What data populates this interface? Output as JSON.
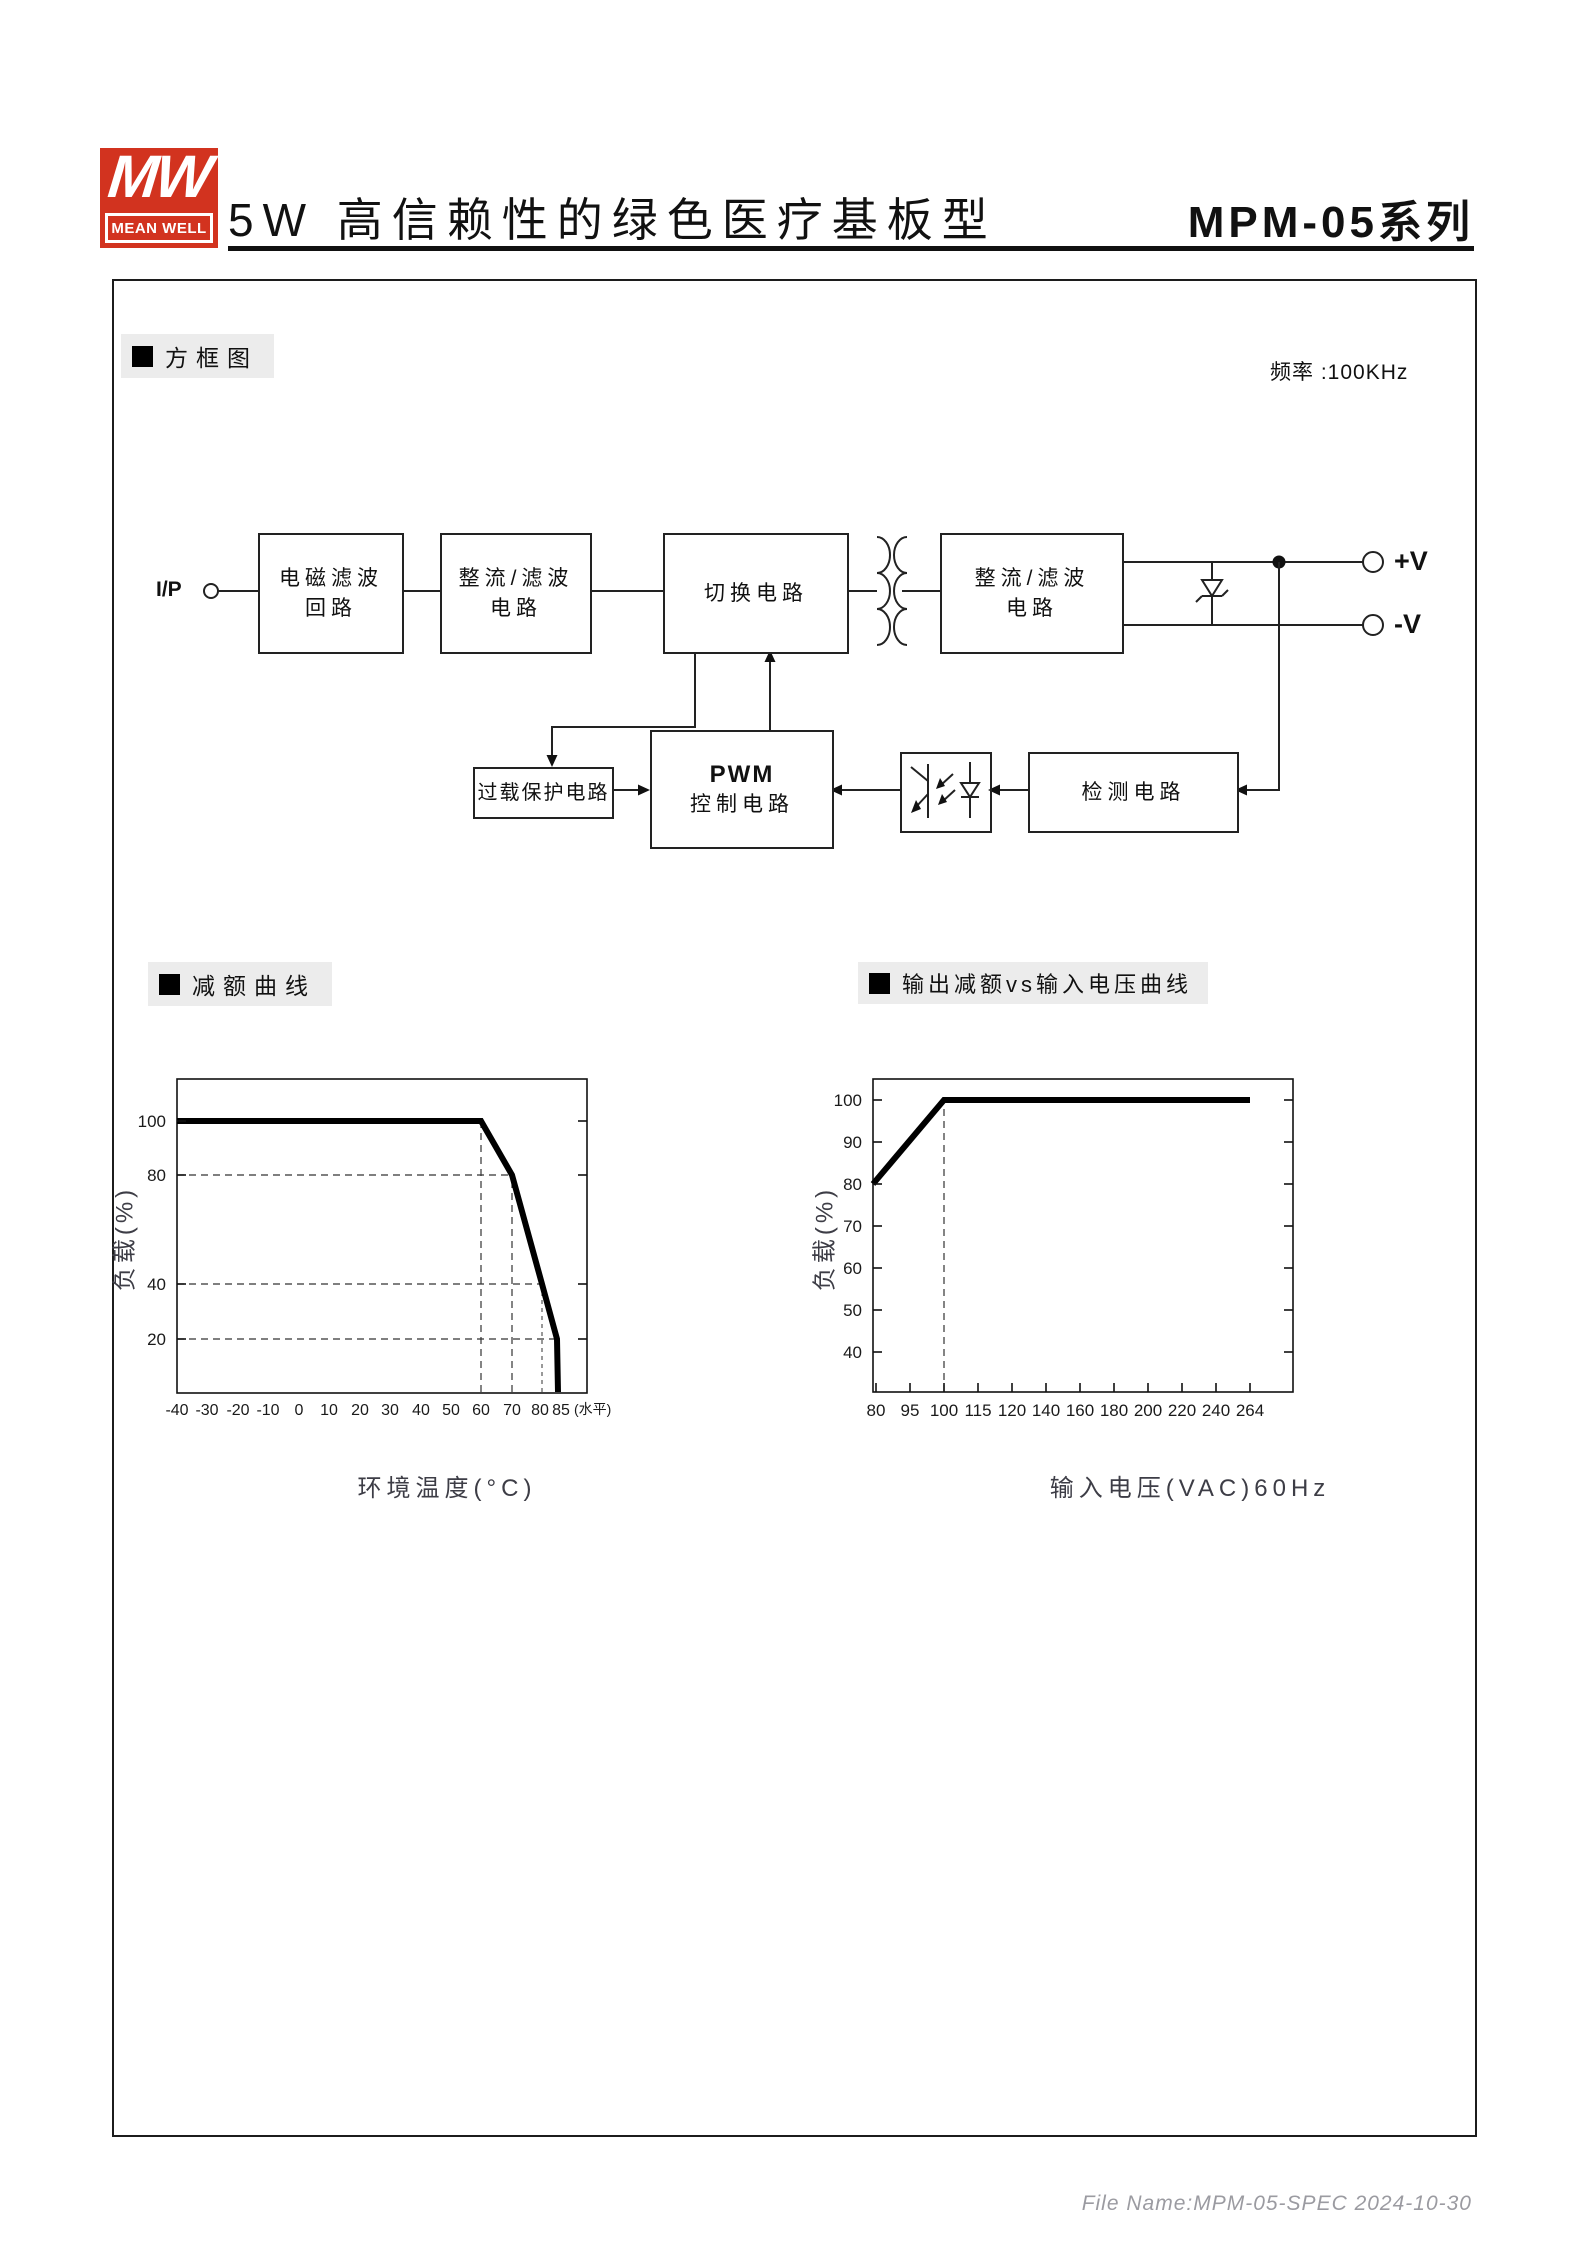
{
  "header": {
    "logo_mw": "MW",
    "logo_name": "MEAN WELL",
    "title": "5W 高信赖性的绿色医疗基板型",
    "series": "MPM-05系列"
  },
  "sections": {
    "block_diagram_label": "方框图",
    "derating_label": "减额曲线",
    "output_derating_label": "输出减额vs输入电压曲线"
  },
  "block_diagram": {
    "frequency_note": "频率 :100KHz",
    "input_label": "I/P",
    "output_pos_label": "+V",
    "output_neg_label": "-V",
    "boxes": {
      "emi_line1": "电磁滤波",
      "emi_line2": "回路",
      "rectifier1_line1": "整流/滤波",
      "rectifier1_line2": "电路",
      "switching": "切换电路",
      "rectifier2_line1": "整流/滤波",
      "rectifier2_line2": "电路",
      "pwm_line1": "PWM",
      "pwm_line2": "控制电路",
      "overload": "过载保护电路",
      "detection": "检测电路"
    }
  },
  "chart_data": [
    {
      "type": "line",
      "title": "减额曲线",
      "xlabel": "环境温度(°C)",
      "ylabel": "负载(%)",
      "x_suffix_note": "(水平)",
      "xlim": [
        -40,
        95
      ],
      "ylim": [
        0,
        112
      ],
      "grid": "dashed guide lines only",
      "x_ticks": [
        -40,
        -30,
        -20,
        -10,
        0,
        10,
        20,
        30,
        40,
        50,
        60,
        70,
        80,
        85
      ],
      "y_ticks": [
        100,
        80,
        40,
        20
      ],
      "series": [
        {
          "name": "load-vs-ambient-temperature",
          "points": [
            [
              -40,
              100
            ],
            [
              60,
              100
            ],
            [
              70,
              80
            ],
            [
              80,
              40
            ],
            [
              85,
              20
            ],
            [
              85.5,
              0
            ]
          ]
        }
      ],
      "dashed_vlines": [
        60,
        70,
        80
      ],
      "dashed_hlines": [
        80,
        40,
        20
      ],
      "legend": "none"
    },
    {
      "type": "line",
      "title": "输出减额vs输入电压曲线",
      "xlabel": "输入电压(VAC)60Hz",
      "ylabel": "负载(%)",
      "xlim_note": "ticks equally spaced despite uneven values",
      "ylim": [
        30,
        105
      ],
      "x_ticks": [
        80,
        95,
        100,
        115,
        120,
        140,
        160,
        180,
        200,
        220,
        240,
        264
      ],
      "y_ticks": [
        100,
        90,
        80,
        70,
        60,
        50,
        40
      ],
      "series": [
        {
          "name": "load-vs-input-voltage",
          "points": [
            [
              80,
              80
            ],
            [
              100,
              100
            ],
            [
              264,
              100
            ]
          ]
        }
      ],
      "dashed_vlines": [
        100
      ],
      "legend": "none"
    }
  ],
  "footer": {
    "file_info": "File Name:MPM-05-SPEC  2024-10-30"
  }
}
